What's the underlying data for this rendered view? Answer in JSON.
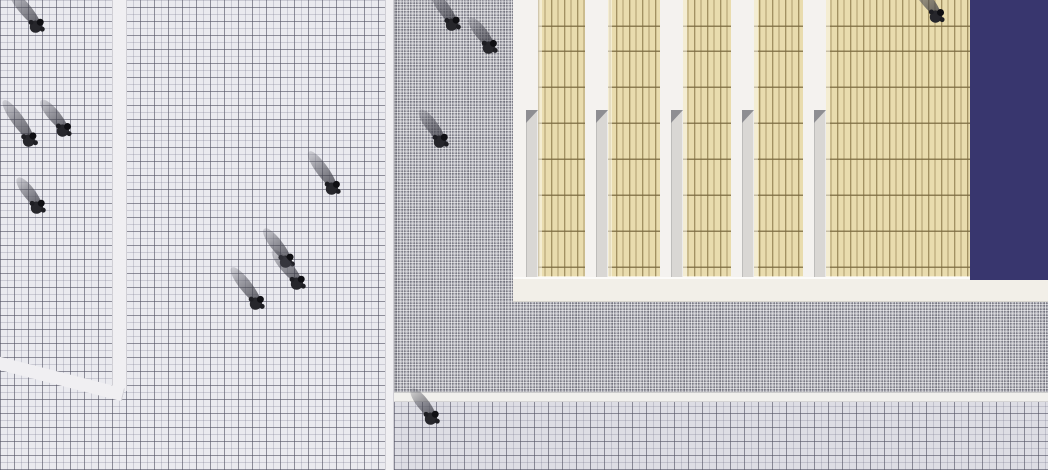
{
  "scene": {
    "width": 1048,
    "height": 470
  },
  "colors": {
    "plaza_fill": "#eaeaef",
    "plaza2_fill": "#dddde4",
    "plaza_line_dark": "rgba(80,80,95,0.5)",
    "plaza_line_light": "rgba(120,120,140,0.28)",
    "strip_white": "#f0eff2",
    "band_white": "#f1f0ed",
    "apron_base": "#b2b2ba",
    "tan": "#e9dcae",
    "tan_stripe": "rgba(125,105,58,0.55)",
    "tan_rule": "rgba(120,104,62,0.8)",
    "gap_white": "#f4f2ef",
    "col_grey": "#d9d7d4",
    "col_tri": "#8e8e92",
    "band_cream": "#f2efe8",
    "pool_navy": "#38366e",
    "person_body": "#26262b",
    "person_head": "#0f0f13"
  },
  "layout": {
    "building_x": 513,
    "roof_gaps_x": [
      585,
      660,
      731,
      803
    ],
    "gap_width": 23,
    "gap_top_height": 110,
    "roof_bottom_y": 277,
    "pool_x": 970,
    "apron_left_x": 394,
    "walk_band_y": 392
  },
  "people": {
    "count": 13,
    "figures": [
      {
        "x": 36,
        "y": 27,
        "heading": 40,
        "shadow_len": 46,
        "shadow_angle": 50
      },
      {
        "x": 29,
        "y": 141,
        "heading": 36,
        "shadow_len": 50,
        "shadow_angle": 54
      },
      {
        "x": 63,
        "y": 131,
        "heading": 44,
        "shadow_len": 40,
        "shadow_angle": 50
      },
      {
        "x": 37,
        "y": 208,
        "heading": 40,
        "shadow_len": 38,
        "shadow_angle": 52
      },
      {
        "x": 332,
        "y": 189,
        "heading": 42,
        "shadow_len": 46,
        "shadow_angle": 54
      },
      {
        "x": 286,
        "y": 262,
        "heading": 38,
        "shadow_len": 42,
        "shadow_angle": 52
      },
      {
        "x": 297,
        "y": 284,
        "heading": 40,
        "shadow_len": 44,
        "shadow_angle": 50
      },
      {
        "x": 256,
        "y": 304,
        "heading": 42,
        "shadow_len": 46,
        "shadow_angle": 52
      },
      {
        "x": 452,
        "y": 25,
        "heading": 38,
        "shadow_len": 40,
        "shadow_angle": 54
      },
      {
        "x": 489,
        "y": 48,
        "heading": 42,
        "shadow_len": 38,
        "shadow_angle": 52
      },
      {
        "x": 440,
        "y": 142,
        "heading": 40,
        "shadow_len": 40,
        "shadow_angle": 53
      },
      {
        "x": 936,
        "y": 17,
        "heading": 44,
        "shadow_len": 44,
        "shadow_angle": 52
      },
      {
        "x": 431,
        "y": 419,
        "heading": 40,
        "shadow_len": 38,
        "shadow_angle": 52
      }
    ]
  }
}
